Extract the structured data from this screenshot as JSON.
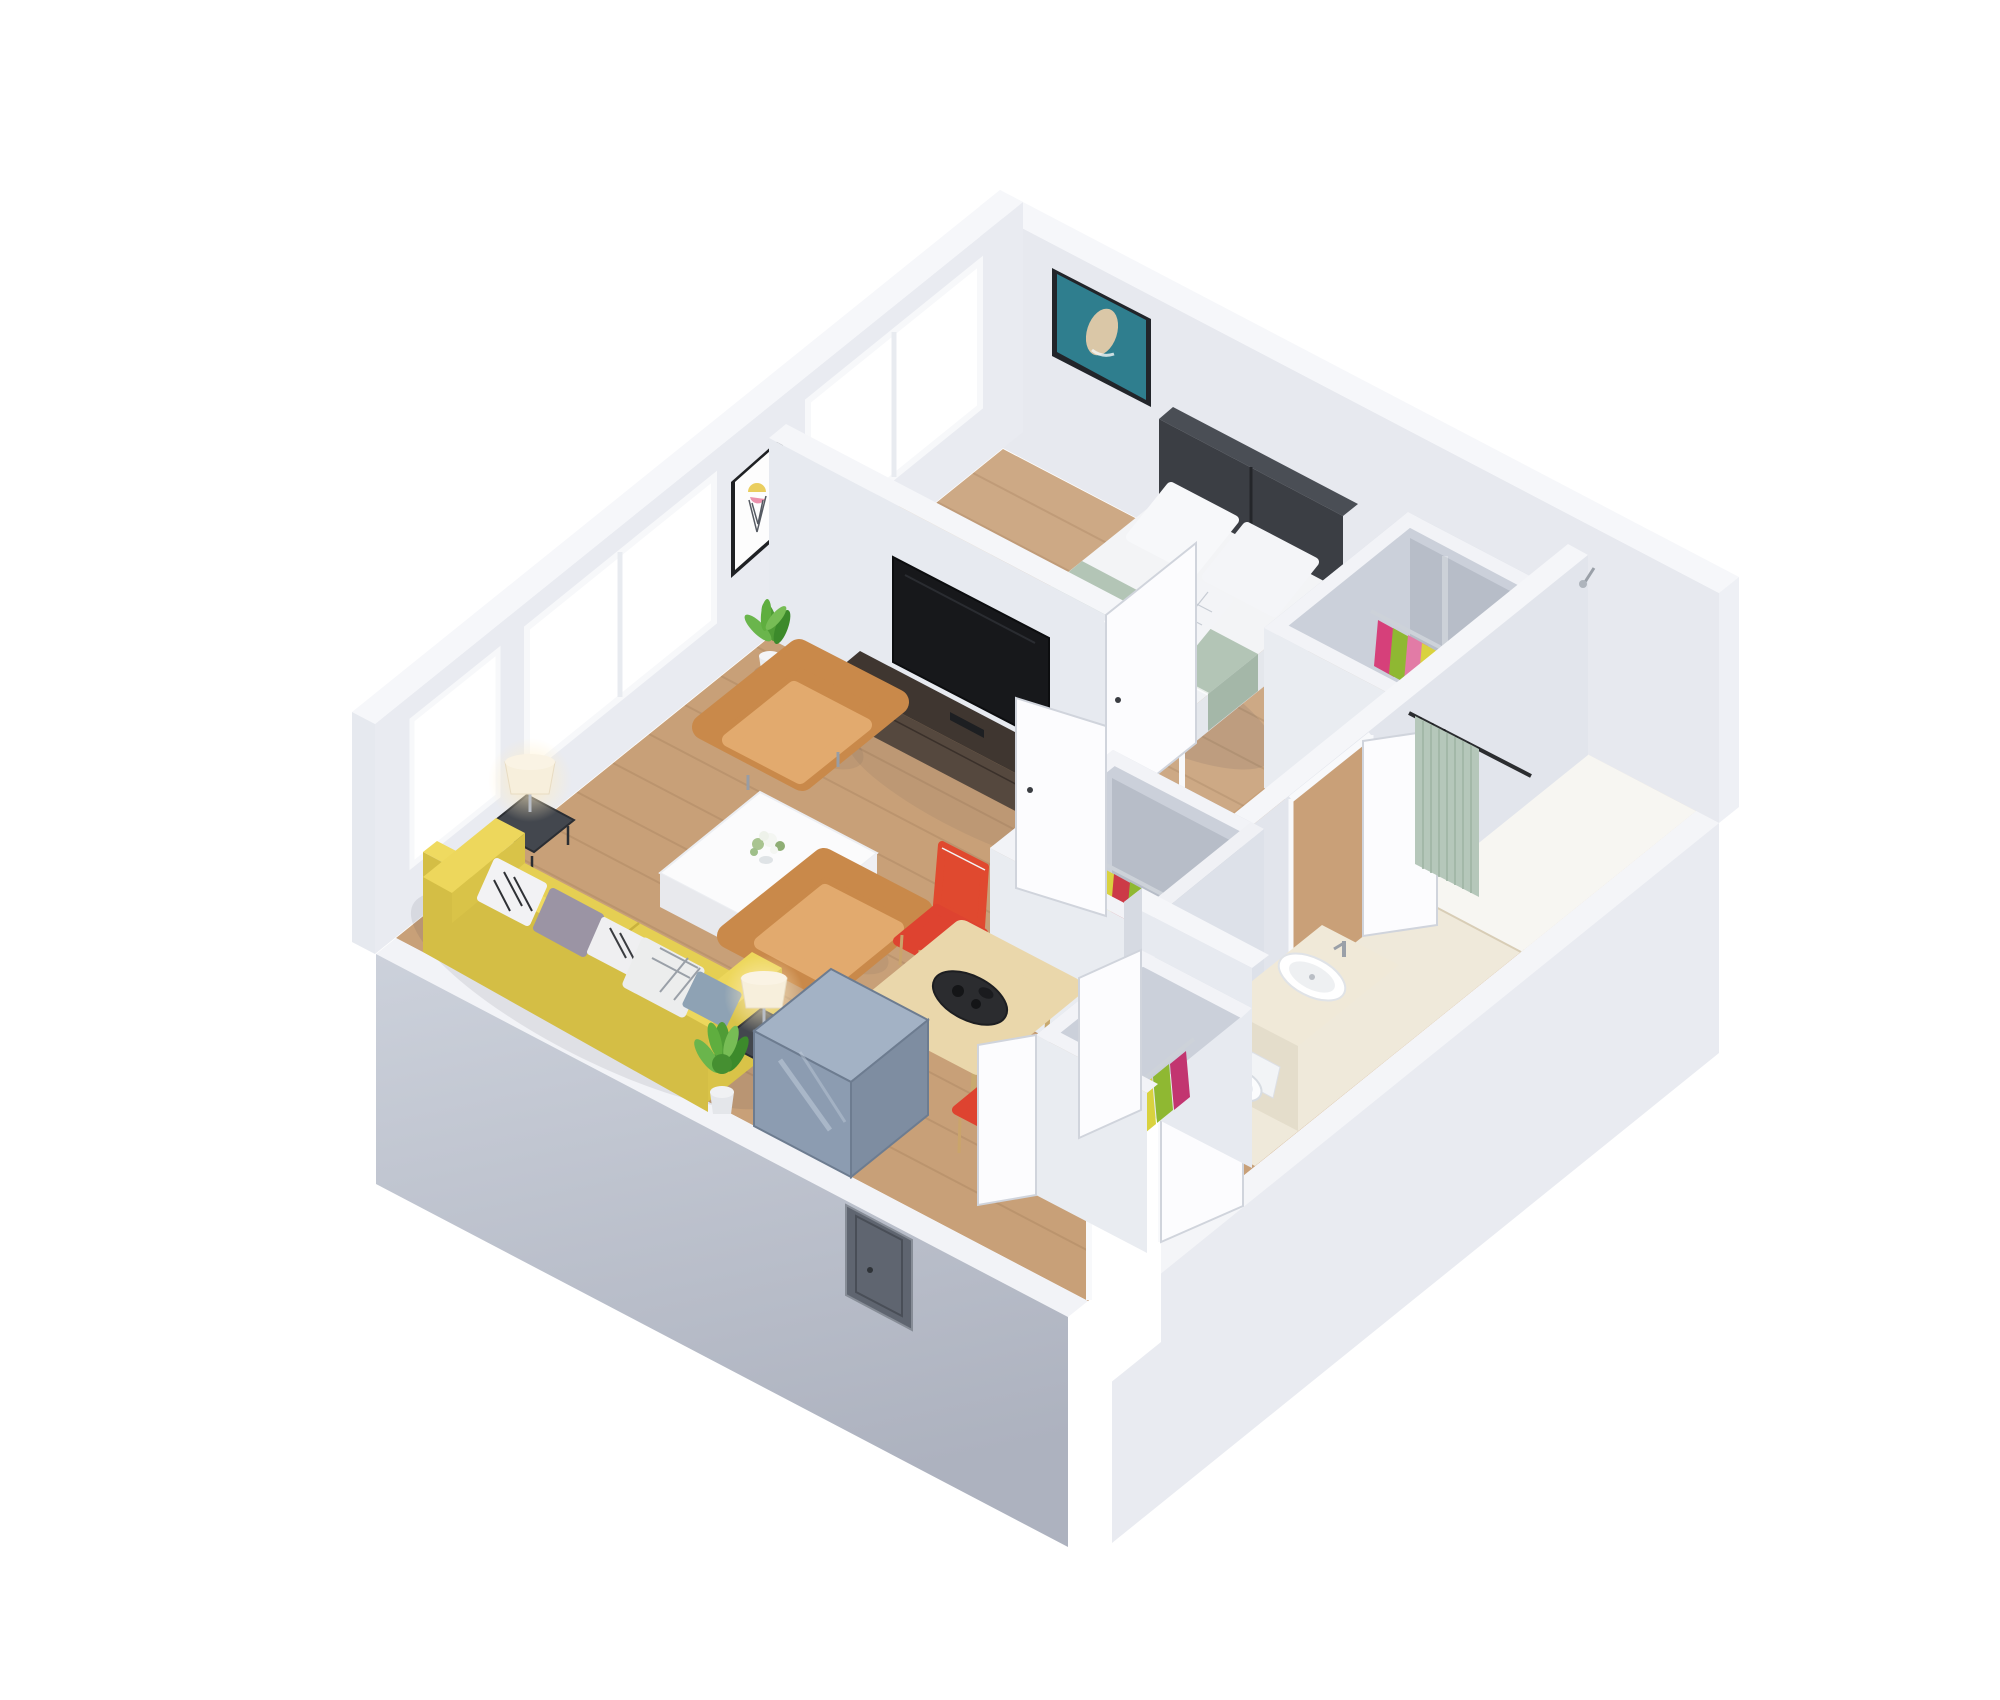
{
  "scene": {
    "type": "3d-floor-plan-render",
    "style": "isometric dollhouse view of a one-bedroom apartment, white background",
    "background": "#ffffff"
  },
  "rooms": [
    {
      "id": "bedroom"
    },
    {
      "id": "living-room"
    },
    {
      "id": "dining-area"
    },
    {
      "id": "hallway"
    },
    {
      "id": "bathroom"
    },
    {
      "id": "closet-bedroom"
    },
    {
      "id": "closet-hallway"
    },
    {
      "id": "closet-entry"
    },
    {
      "id": "entry"
    }
  ],
  "furniture": [
    {
      "id": "double-bed"
    },
    {
      "id": "headboard"
    },
    {
      "id": "bed-pillows"
    },
    {
      "id": "bedroom-armchair"
    },
    {
      "id": "bedroom-side-table"
    },
    {
      "id": "wall-art-bedroom"
    },
    {
      "id": "wall-art-living"
    },
    {
      "id": "tv-console"
    },
    {
      "id": "tv"
    },
    {
      "id": "potted-plant-1"
    },
    {
      "id": "potted-plant-2"
    },
    {
      "id": "armchair-1"
    },
    {
      "id": "armchair-2"
    },
    {
      "id": "coffee-table"
    },
    {
      "id": "sofa"
    },
    {
      "id": "sofa-pillows"
    },
    {
      "id": "table-lamp-1"
    },
    {
      "id": "table-lamp-2"
    },
    {
      "id": "storage-cabinet"
    },
    {
      "id": "dining-table"
    },
    {
      "id": "dining-tray"
    },
    {
      "id": "dining-chair-1"
    },
    {
      "id": "dining-chair-2"
    },
    {
      "id": "wardrobe-rails"
    },
    {
      "id": "hanging-clothes"
    },
    {
      "id": "shower-curtain"
    },
    {
      "id": "shower-rod"
    },
    {
      "id": "bathroom-counter"
    },
    {
      "id": "bathroom-sink"
    },
    {
      "id": "toilet"
    },
    {
      "id": "entry-door"
    },
    {
      "id": "interior-doors"
    },
    {
      "id": "utility-panel"
    },
    {
      "id": "windows"
    }
  ],
  "palette": {
    "background": "#ffffff",
    "floorWood": "#c8a078",
    "floorBathroom": "#efe9da",
    "showerTray": "#f7f6f2",
    "wallTop": "#f6f7fa",
    "wallInner": "#e9ebf1",
    "wallInnerNE": "#e7e9ef",
    "wallFace": "#e7eaf0",
    "wallShade": "#d8dce4",
    "slabSE": "#e9ebf1",
    "slabSW1": "#ccd1db",
    "slabSW2": "#adb2bf",
    "window": "#ffffff",
    "door": "#fcfcfe",
    "panel": "#5f6570",
    "sofa": "#e5cf53",
    "sofaShade": "#d4be45",
    "armchair": "#c9894a",
    "armchairSeat": "#e2aa6e",
    "bedroomChair": "#e6c193",
    "chairRed": "#de4330",
    "tableWood": "#ead7ab",
    "tray": "#2b2c2f",
    "consoleTop": "#3f3630",
    "consoleFront": "#55483e",
    "tv": "#17181b",
    "headboard": "#3b3e44",
    "bedding": "#f3f4f6",
    "sage": "#b3c5b6",
    "curtain": "#b5c7ba",
    "counter": "#f0e9d8",
    "basin": "#ffffff",
    "boxTop": "#a3b2c5",
    "boxFront": "#8c9cb1",
    "lampShade": "#f7efdc",
    "lampGlow": "#ffe9b8",
    "plant": "#4f9c36",
    "closetBack": "#b7bdc8",
    "railChrome": "#cdd2d9",
    "artTeal": "#2f7e8e",
    "clothes": [
      "#d6407a",
      "#8fb832",
      "#e27ba6",
      "#d9d23f",
      "#cdbd8a",
      "#cc3a47",
      "#76a62c",
      "#c23570"
    ]
  }
}
